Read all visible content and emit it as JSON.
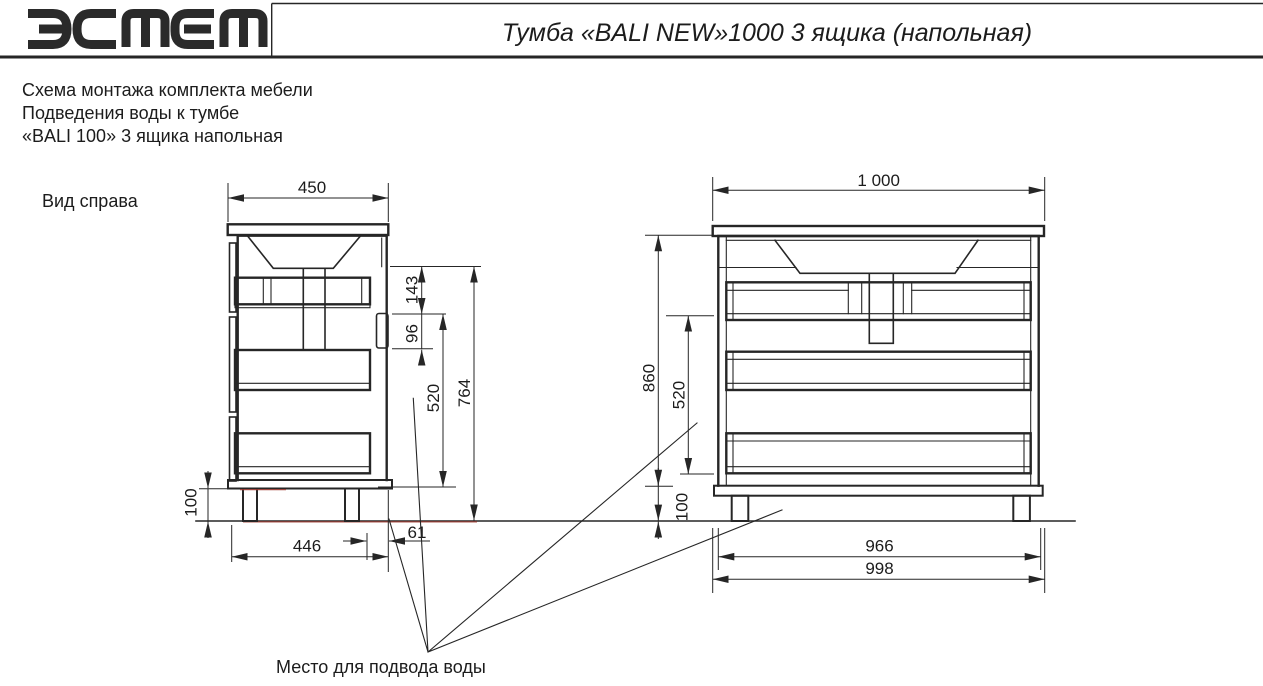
{
  "header": {
    "brand": "эстет",
    "title": "Тумба «BALI NEW»1000 3 ящика (напольная)"
  },
  "subtitle": {
    "line1": "Схема монтажа комплекта мебели",
    "line2": "Подведения воды к тумбе",
    "line3": "«BALI 100» 3 ящика напольная"
  },
  "side_view": {
    "label": "Вид справа",
    "dim_width": "450",
    "dim_sink_zone": "143",
    "dim_handle_zone": "96",
    "dim_drawers_height": "520",
    "dim_body_height": "764",
    "dim_legs_height": "100",
    "dim_depth": "446",
    "dim_back_gap": "61"
  },
  "front_view": {
    "dim_width": "1 000",
    "dim_total_height": "860",
    "dim_drawers_height": "520",
    "dim_legs_height": "100",
    "dim_legs_span": "966",
    "dim_base_width": "998"
  },
  "annotation": {
    "water": "Место для подвода воды"
  },
  "colors": {
    "line": "#262626",
    "accent_red": "#a0392f",
    "background": "#ffffff"
  }
}
